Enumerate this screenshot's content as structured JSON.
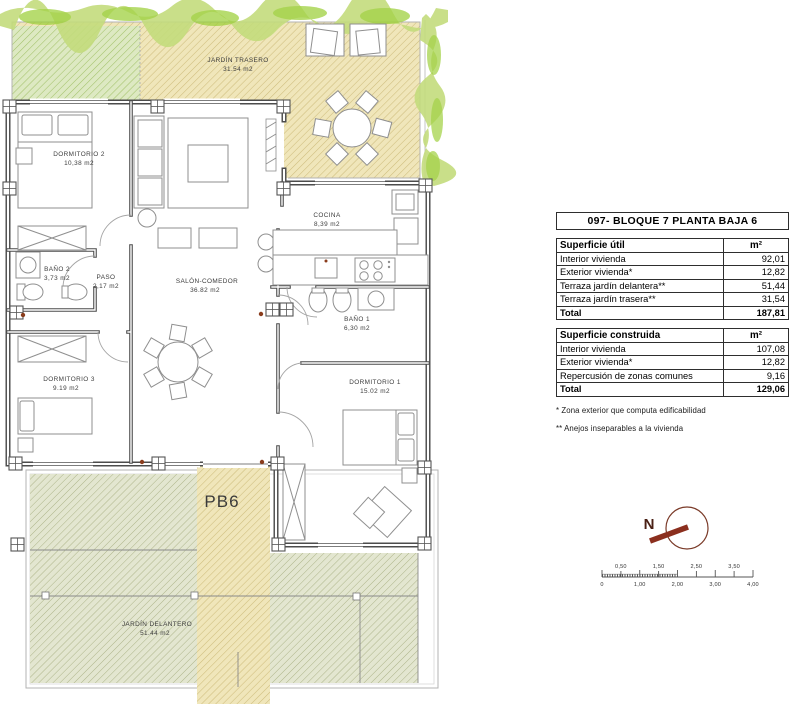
{
  "plan": {
    "unit_label": "PB6",
    "north_label": "N",
    "rooms": [
      {
        "name": "JARDÍN TRASERO",
        "area": "31.54 m2"
      },
      {
        "name": "DORMITORIO 2",
        "area": "10,38 m2"
      },
      {
        "name": "COCINA",
        "area": "8,39 m2"
      },
      {
        "name": "BAÑO 2",
        "area": "3,73 m2"
      },
      {
        "name": "PASO",
        "area": "2,17 m2"
      },
      {
        "name": "SALÓN-COMEDOR",
        "area": "36.82 m2"
      },
      {
        "name": "BAÑO 1",
        "area": "6,30 m2"
      },
      {
        "name": "DORMITORIO 3",
        "area": "9.19 m2"
      },
      {
        "name": "DORMITORIO 1",
        "area": "15.02 m2"
      },
      {
        "name": "JARDÍN DELANTERO",
        "area": "51.44 m2"
      }
    ],
    "scale_bar": {
      "top_labels": [
        "0,50",
        "1,50",
        "2,50",
        "3,50"
      ],
      "bottom_labels": [
        "0",
        "1,00",
        "2,00",
        "3,00",
        "4,00"
      ]
    }
  },
  "panel": {
    "title": "097- BLOQUE 7 PLANTA BAJA 6",
    "surface_util": {
      "header_label": "Superficie útil",
      "unit": "m²",
      "rows": [
        {
          "label": "Interior vivienda",
          "value": "92,01"
        },
        {
          "label": "Exterior vivienda*",
          "value": "12,82"
        },
        {
          "label": "Terraza jardín delantera**",
          "value": "51,44"
        },
        {
          "label": "Terraza jardín trasera**",
          "value": "31,54"
        }
      ],
      "total_label": "Total",
      "total_value": "187,81"
    },
    "surface_construida": {
      "header_label": "Superficie construida",
      "unit": "m²",
      "rows": [
        {
          "label": "Interior vivienda",
          "value": "107,08"
        },
        {
          "label": "Exterior vivienda*",
          "value": "12,82"
        },
        {
          "label": "Repercusión de zonas comunes",
          "value": "9,16"
        }
      ],
      "total_label": "Total",
      "total_value": "129,06"
    },
    "footnotes": [
      "* Zona exterior que computa edificabilidad",
      "** Anejos inseparables a la vivienda"
    ]
  },
  "colors": {
    "garden_tan": "#f0e6ba",
    "garden_tan_line": "#cfbd7d",
    "front_garden_green": "#e3e6d0",
    "front_garden_line": "#adb489",
    "back_garden_green": "#dde9c2",
    "back_garden_line": "#a3c26b",
    "vegetation_light": "#c3dc7c",
    "vegetation_dark": "#9bce37",
    "north_arrow": "#8b2f1e",
    "wall": "#4c4c4c"
  }
}
